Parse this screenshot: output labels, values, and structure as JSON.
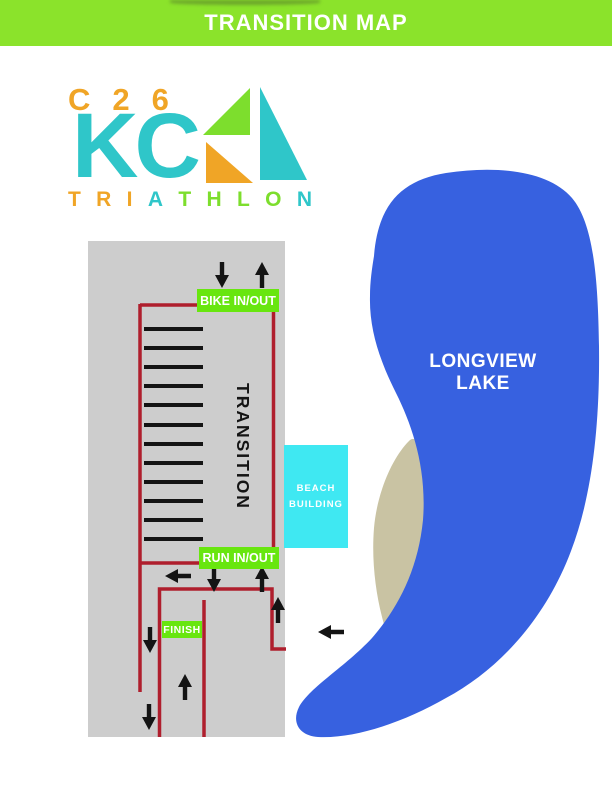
{
  "header": {
    "title": "TRANSITION MAP",
    "bg_color": "#8BE32B",
    "text_color": "#FFFFFF"
  },
  "logo": {
    "line1": "C26",
    "line2": "KC",
    "word_letters": [
      {
        "ch": "T",
        "color": "#F0A526"
      },
      {
        "ch": "R",
        "color": "#F0A526"
      },
      {
        "ch": "I",
        "color": "#F0A526"
      },
      {
        "ch": "A",
        "color": "#2FC6C9"
      },
      {
        "ch": "T",
        "color": "#7DDE2D"
      },
      {
        "ch": "H",
        "color": "#7DDE2D"
      },
      {
        "ch": "L",
        "color": "#7DDE2D"
      },
      {
        "ch": "O",
        "color": "#7DDE2D"
      },
      {
        "ch": "N",
        "color": "#2FC6C9"
      }
    ],
    "colors": {
      "orange": "#F0A526",
      "teal": "#2FC6C9",
      "green": "#7DDE2D"
    }
  },
  "map": {
    "transition_label": "TRANSITION",
    "bike_inout_label": "BIKE IN/OUT",
    "run_inout_label": "RUN IN/OUT",
    "finish_label": "FINISH",
    "beach_building_label": "BEACH BUILDING",
    "lake_label": "LONGVIEW LAKE",
    "rack_count": 12,
    "colors": {
      "ground": "#CDCDCD",
      "route": "#AF1E2D",
      "label_green": "#68E60F",
      "lake": "#3761E0",
      "beach": "#C9C3A3",
      "building": "#3FE8F2",
      "rack": "#141414"
    }
  }
}
